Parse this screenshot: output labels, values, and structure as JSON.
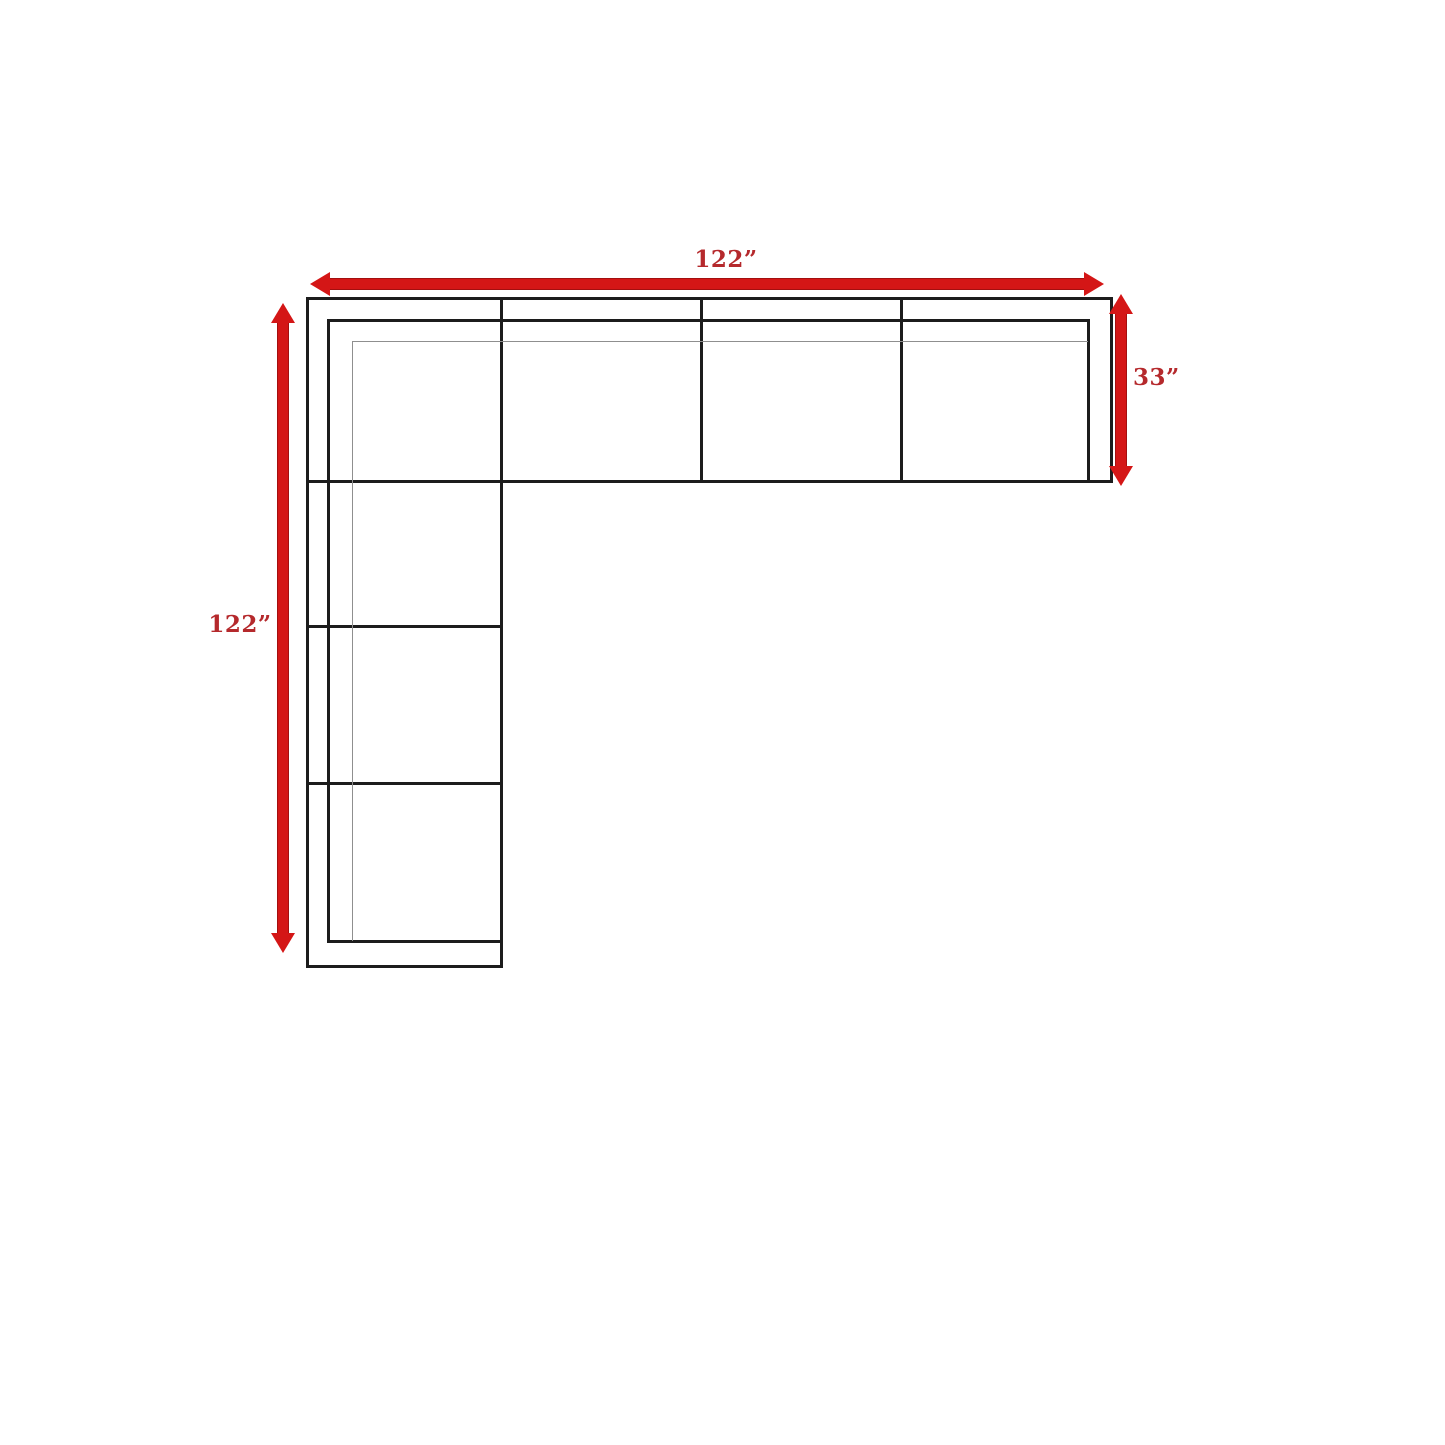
{
  "diagram": {
    "title": "L-shaped sectional sofa dimension diagram (top view)",
    "dimensions": {
      "width_label": "122”",
      "depth_label": "33”",
      "height_label": "122”"
    }
  },
  "colors": {
    "background": "#ffffff",
    "line": "#1c1c1c",
    "thin_line": "#8f8f8f",
    "arrow": "#d41616",
    "arrow_edge": "#a30f0f",
    "label": "#b5292c"
  }
}
